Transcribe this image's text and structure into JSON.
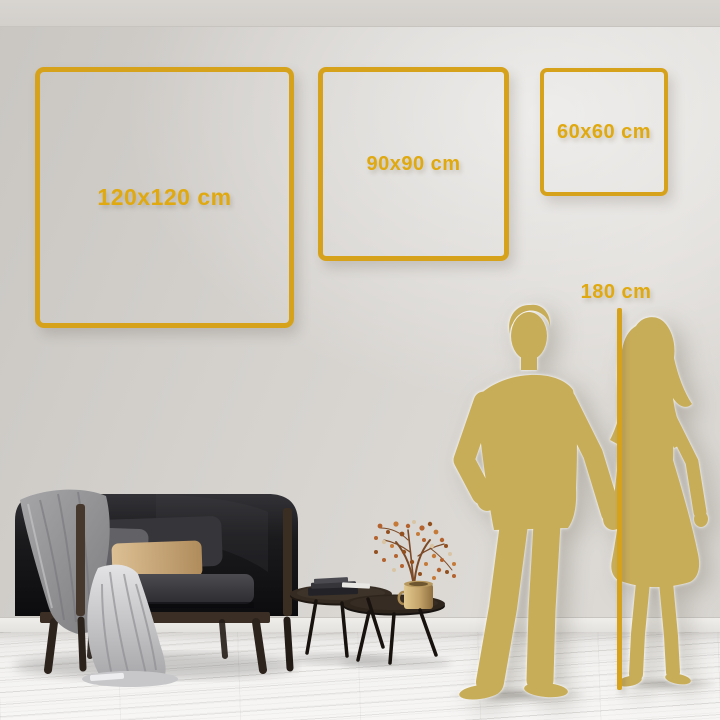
{
  "size_guide": {
    "frames": [
      {
        "label": "120x120 cm"
      },
      {
        "label": "90x90 cm"
      },
      {
        "label": "60x60 cm"
      }
    ],
    "height_marker": {
      "label": "180 cm"
    }
  },
  "colors": {
    "accent_gold": "#d7a21b",
    "label_gold": "#e0a90f",
    "silhouette_gold": "#c8ad59",
    "wall_grey": "#d5d2ce",
    "floor_white": "#f3f2f0"
  },
  "scene": {
    "objects": [
      "man-silhouette",
      "woman-silhouette",
      "height-line",
      "sofa",
      "throw-blanket",
      "cushions",
      "nesting-coffee-tables",
      "books",
      "gold-vase",
      "dried-branch",
      "wood-plank-floor"
    ]
  }
}
